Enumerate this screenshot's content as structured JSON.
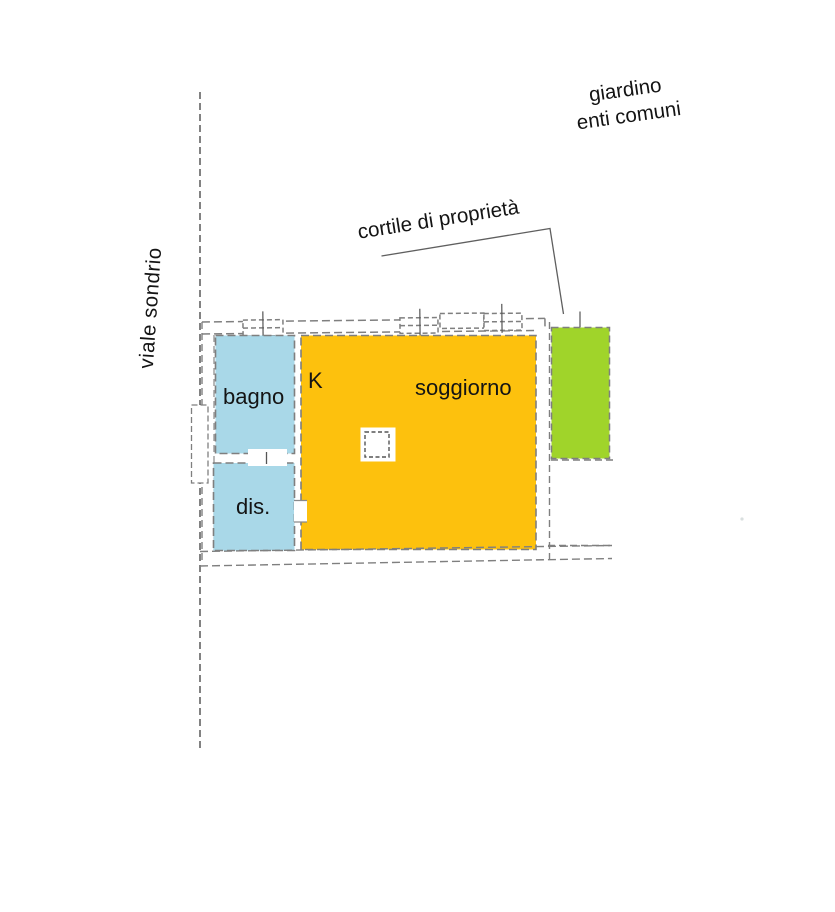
{
  "labels": {
    "street": "viale sondrio",
    "garden": {
      "line1": "giardino",
      "line2": "enti comuni"
    },
    "courtyard": "cortile di proprietà",
    "bathroom": "bagno",
    "hallway": "dis.",
    "kitchen": "K",
    "living_room": "soggiorno"
  },
  "colors": {
    "bathroom": "#a9d8e8",
    "hallway": "#a9d8e8",
    "living_room": "#fdc10d",
    "courtyard": "#a0d42a",
    "wall_stroke": "#7f7f7f",
    "boundary_stroke": "#4d4d4d",
    "leader_stroke": "#5f5f5f"
  }
}
